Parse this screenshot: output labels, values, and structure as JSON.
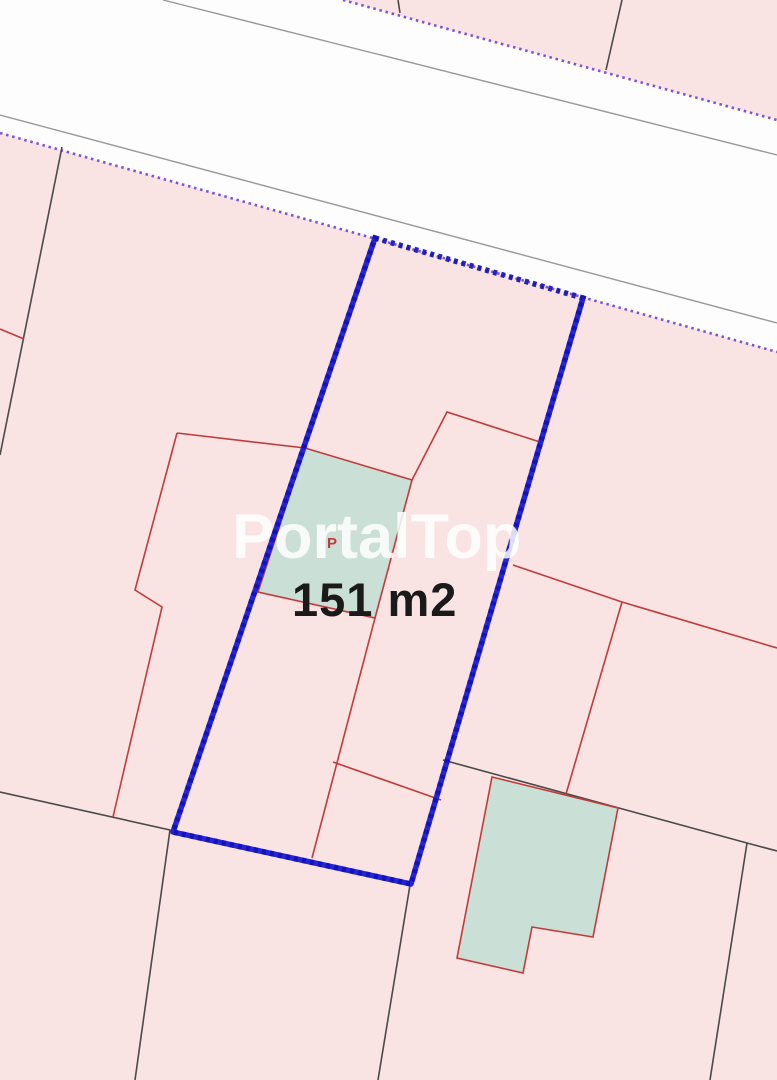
{
  "map": {
    "watermark_text": "PortalTop",
    "parcel": {
      "area_label": "151 m2",
      "building_mark": "P"
    },
    "colors": {
      "parcel_fill": "#f9e3e3",
      "road_fill": "#fefdfd",
      "building_fill": "#cadfd5",
      "highlight_blue": "#2525d6",
      "highlight_blue_dark": "#1111b4",
      "boundary_red": "#c23b3b",
      "boundary_black": "#4a4a4a",
      "road_edge_gray": "#9a9a9a",
      "boundary_purple": "#7e52d4",
      "watermark_color": "rgba(255,255,255,0.85)",
      "area_text_color": "#1a1a1a"
    }
  }
}
